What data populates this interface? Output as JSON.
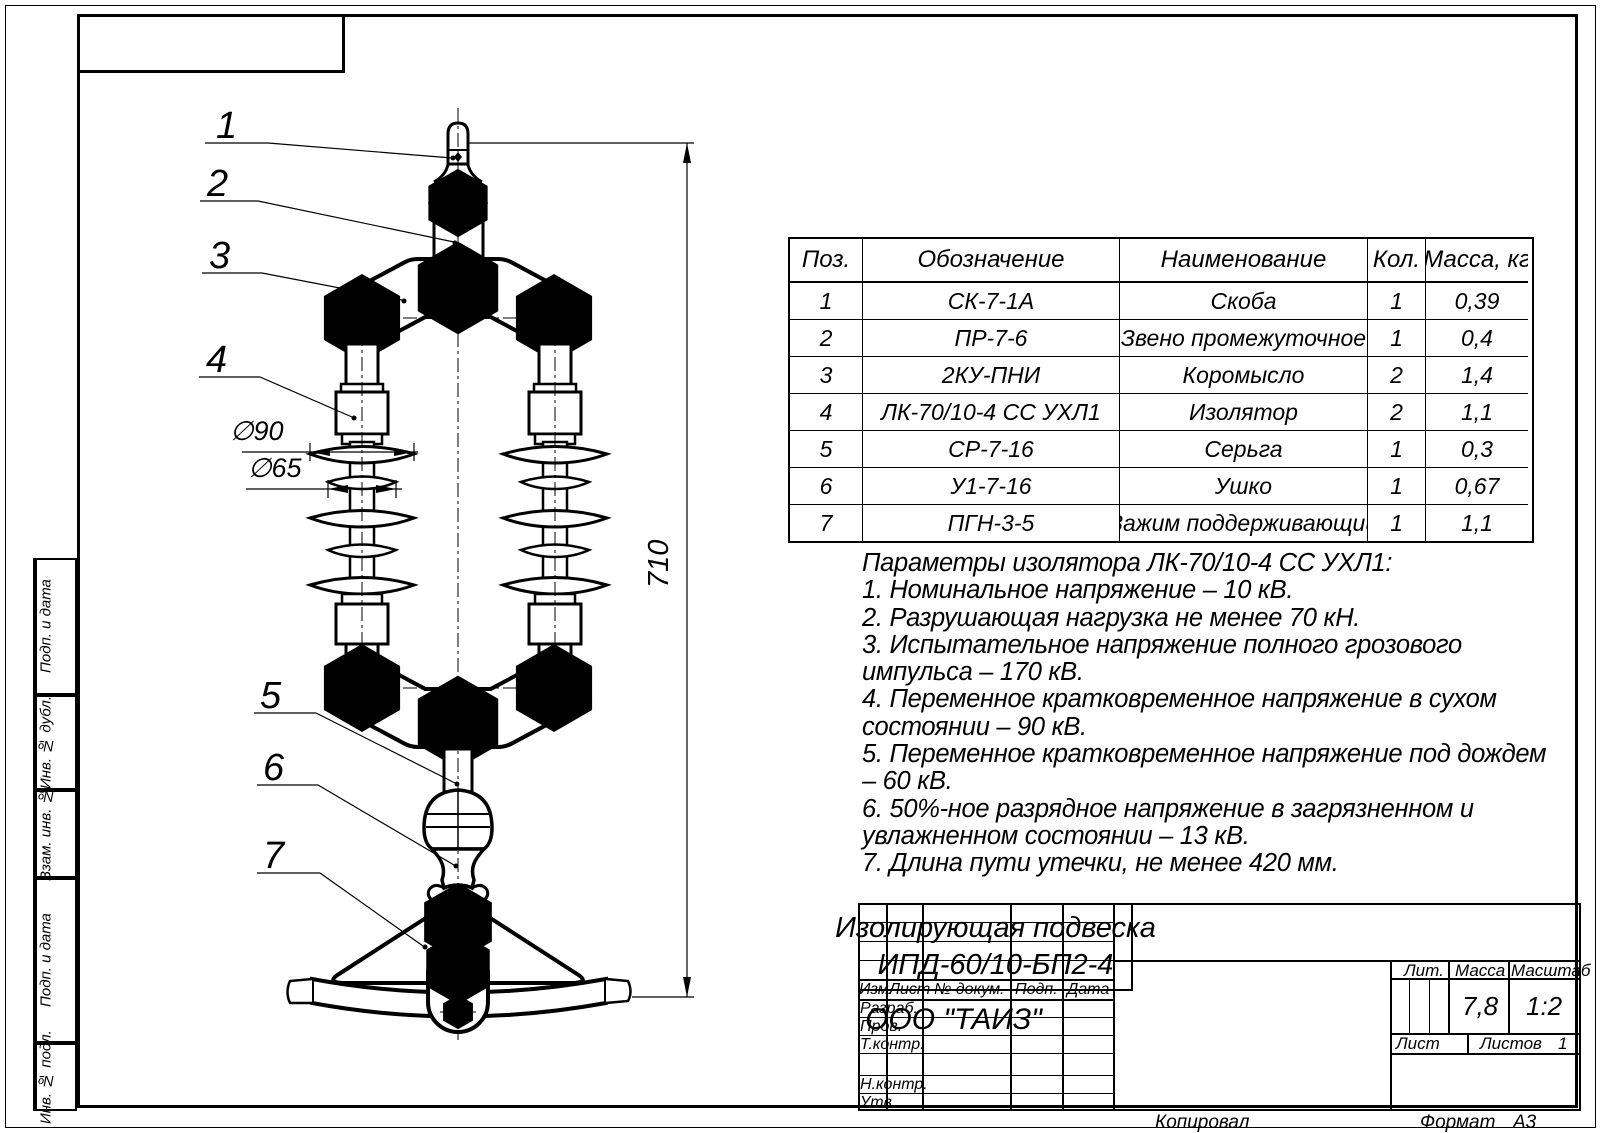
{
  "drawing": {
    "callouts": [
      "1",
      "2",
      "3",
      "4",
      "5",
      "6",
      "7"
    ],
    "dim_d90": "∅90",
    "dim_d65": "∅65",
    "dim_height": "710"
  },
  "parts_table": {
    "headers": [
      "Поз.",
      "Обозначение",
      "Наименование",
      "Кол.",
      "Масса, кг"
    ],
    "rows": [
      [
        "1",
        "СК-7-1А",
        "Скоба",
        "1",
        "0,39"
      ],
      [
        "2",
        "ПР-7-6",
        "Звено промежуточное",
        "1",
        "0,4"
      ],
      [
        "3",
        "2КУ-ПНИ",
        "Коромысло",
        "2",
        "1,4"
      ],
      [
        "4",
        "ЛК-70/10-4 СС УХЛ1",
        "Изолятор",
        "2",
        "1,1"
      ],
      [
        "5",
        "СР-7-16",
        "Серьга",
        "1",
        "0,3"
      ],
      [
        "6",
        "У1-7-16",
        "Ушко",
        "1",
        "0,67"
      ],
      [
        "7",
        "ПГН-3-5",
        "Зажим поддерживающий",
        "1",
        "1,1"
      ]
    ]
  },
  "notes": {
    "lines": [
      "Параметры изолятора ЛК-70/10-4 СС УХЛ1:",
      "1. Номинальное напряжение – 10 кВ.",
      "2. Разрушающая нагрузка не менее 70 кН.",
      "3. Испытательное напряжение полного грозового",
      "импульса – 170 кВ.",
      "4. Переменное кратковременное напряжение  в сухом",
      "состоянии – 90 кВ.",
      "5. Переменное кратковременное напряжение под дождем",
      "– 60 кВ.",
      "6. 50%-ное разрядное напряжение в загрязненном и",
      "увлажненном состоянии – 13 кВ.",
      "7. Длина пути утечки, не менее 420 мм."
    ]
  },
  "title_block": {
    "col_headers": [
      "Изм.",
      "Лист",
      "№ докум.",
      "Подп.",
      "Дата"
    ],
    "row_labels": [
      "Разраб.",
      "Пров.",
      "Т.контр.",
      "Н.контр.",
      "Утв."
    ],
    "doc_title_line1": "Изолирующая подвеска",
    "doc_title_line2": "ИПД-60/10-БП2-4",
    "lit_label": "Лит.",
    "mass_label": "Масса",
    "scale_label": "Масштаб",
    "mass_value": "7,8",
    "scale_value": "1:2",
    "sheet_label": "Лист",
    "sheets_label": "Листов",
    "sheets_value": "1",
    "company": "ООО \"ТАИЗ\""
  },
  "margins": {
    "left_labels": [
      "Подп. и дата",
      "Инв. № дубл.",
      "Взам. инв. №",
      "Подп. и дата",
      "Инв. № подл."
    ],
    "bottom_left": "Копировал",
    "format_label": "Формат",
    "format_value": "А3"
  }
}
